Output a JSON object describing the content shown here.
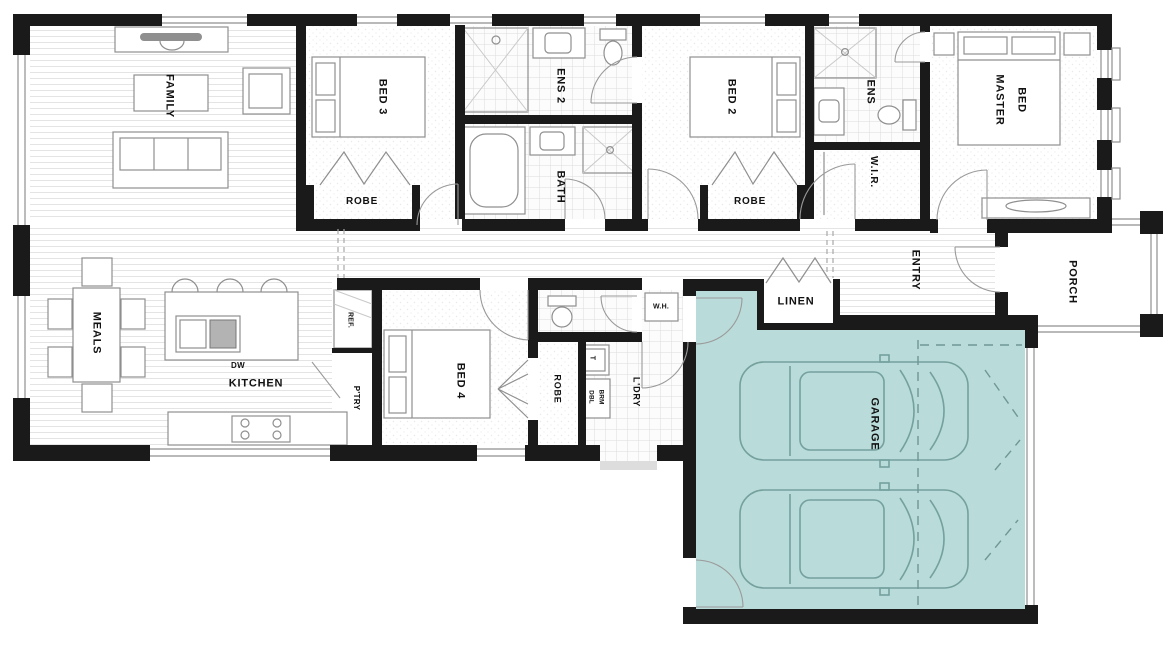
{
  "rooms": {
    "family": "FAMILY",
    "meals": "MEALS",
    "kitchen": "KITCHEN",
    "bed_3": "BED 3",
    "robe_bed3": "ROBE",
    "ens_2": "ENS 2",
    "bath": "BATH",
    "bed_2": "BED 2",
    "robe_bed2": "ROBE",
    "ens": "ENS",
    "wir": "W.I.R.",
    "master_line1": "MASTER",
    "master_line2": "BED",
    "bed_4": "BED 4",
    "robe_bed4": "ROBE",
    "ldry": "L'DRY",
    "linen": "LINEN",
    "entry": "ENTRY",
    "porch": "PORCH",
    "garage": "GARAGE"
  },
  "small_labels": {
    "ref": "REF.",
    "ptry": "P'TRY",
    "dw": "DW",
    "trough": "T",
    "dbl": "DBL",
    "brm": "BRM",
    "wh": "W.H."
  },
  "colors": {
    "garage_highlight": "#b9dbd9",
    "wall": "#1a1a1a",
    "car_outline": "#74a09e"
  }
}
